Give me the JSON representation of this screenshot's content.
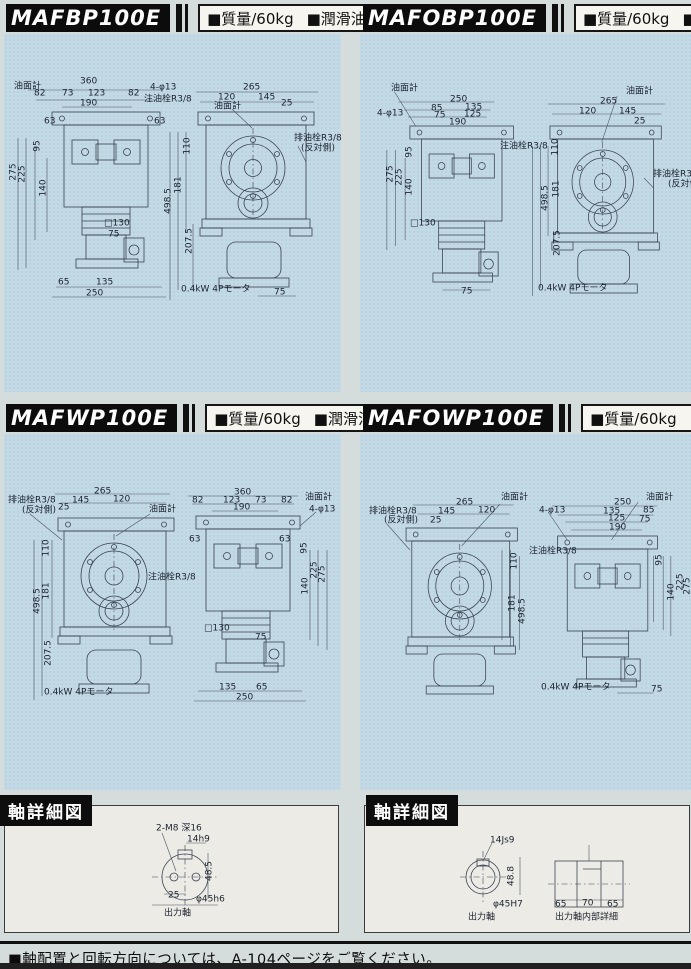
{
  "page": {
    "footer_note": "■軸配置と回転方向については、A-104ページをご覧ください。"
  },
  "panels": [
    {
      "model": "MAFBP100E",
      "mass_label": "■質量/60kg",
      "oil_label": "■潤滑油量/2.5",
      "labels": [
        {
          "t": "油面計",
          "x": 14,
          "y": 87,
          "n": "oil-gauge-label"
        },
        {
          "t": "360",
          "x": 80,
          "y": 82
        },
        {
          "t": "82",
          "x": 34,
          "y": 94
        },
        {
          "t": "73",
          "x": 62,
          "y": 94
        },
        {
          "t": "123",
          "x": 88,
          "y": 94
        },
        {
          "t": "82",
          "x": 128,
          "y": 94
        },
        {
          "t": "190",
          "x": 80,
          "y": 104
        },
        {
          "t": "4-φ13",
          "x": 150,
          "y": 88
        },
        {
          "t": "注油栓R3/8",
          "x": 144,
          "y": 100,
          "n": "filler-plug-label"
        },
        {
          "t": "63",
          "x": 44,
          "y": 122
        },
        {
          "t": "63",
          "x": 154,
          "y": 122
        },
        {
          "t": "95",
          "x": 38,
          "y": 146,
          "v": 1
        },
        {
          "t": "275",
          "x": 14,
          "y": 172,
          "v": 1
        },
        {
          "t": "225",
          "x": 23,
          "y": 174,
          "v": 1
        },
        {
          "t": "140",
          "x": 44,
          "y": 188,
          "v": 1
        },
        {
          "t": "□130",
          "x": 104,
          "y": 224
        },
        {
          "t": "75",
          "x": 108,
          "y": 235
        },
        {
          "t": "65",
          "x": 58,
          "y": 283
        },
        {
          "t": "135",
          "x": 96,
          "y": 283
        },
        {
          "t": "250",
          "x": 86,
          "y": 294
        },
        {
          "t": "265",
          "x": 243,
          "y": 88
        },
        {
          "t": "120",
          "x": 218,
          "y": 98
        },
        {
          "t": "145",
          "x": 258,
          "y": 98
        },
        {
          "t": "25",
          "x": 281,
          "y": 104
        },
        {
          "t": "油面計",
          "x": 214,
          "y": 107,
          "n": "oil-gauge-label"
        },
        {
          "t": "排油栓R3/8",
          "x": 294,
          "y": 139,
          "n": "drain-plug-label"
        },
        {
          "t": "(反対側)",
          "x": 301,
          "y": 149
        },
        {
          "t": "110",
          "x": 188,
          "y": 146,
          "v": 1
        },
        {
          "t": "181",
          "x": 179,
          "y": 185,
          "v": 1
        },
        {
          "t": "498.5",
          "x": 169,
          "y": 201,
          "v": 1
        },
        {
          "t": "207.5",
          "x": 190,
          "y": 241,
          "v": 1
        },
        {
          "t": "0.4kW 4Pモータ",
          "x": 181,
          "y": 290,
          "n": "motor-label"
        },
        {
          "t": "75",
          "x": 274,
          "y": 293
        }
      ]
    },
    {
      "model": "MAFOBP100E",
      "mass_label": "■質量/60kg",
      "oil_label": "■潤滑油量/2.5",
      "labels": [
        {
          "t": "油面計",
          "x": 31,
          "y": 89,
          "n": "oil-gauge-label"
        },
        {
          "t": "250",
          "x": 90,
          "y": 100
        },
        {
          "t": "85",
          "x": 71,
          "y": 109
        },
        {
          "t": "135",
          "x": 105,
          "y": 108
        },
        {
          "t": "75",
          "x": 74,
          "y": 116
        },
        {
          "t": "125",
          "x": 104,
          "y": 115
        },
        {
          "t": "190",
          "x": 89,
          "y": 123
        },
        {
          "t": "4-φ13",
          "x": 17,
          "y": 114
        },
        {
          "t": "95",
          "x": 50,
          "y": 152,
          "v": 1
        },
        {
          "t": "275",
          "x": 31,
          "y": 174,
          "v": 1
        },
        {
          "t": "225",
          "x": 40,
          "y": 177,
          "v": 1
        },
        {
          "t": "140",
          "x": 50,
          "y": 187,
          "v": 1
        },
        {
          "t": "注油栓R3/8",
          "x": 140,
          "y": 147,
          "n": "filler-plug-label"
        },
        {
          "t": "□130",
          "x": 50,
          "y": 224
        },
        {
          "t": "75",
          "x": 101,
          "y": 292
        },
        {
          "t": "油面計",
          "x": 266,
          "y": 92,
          "n": "oil-gauge-label"
        },
        {
          "t": "265",
          "x": 240,
          "y": 102
        },
        {
          "t": "120",
          "x": 219,
          "y": 112
        },
        {
          "t": "145",
          "x": 259,
          "y": 112
        },
        {
          "t": "25",
          "x": 274,
          "y": 122
        },
        {
          "t": "110",
          "x": 196,
          "y": 147,
          "v": 1
        },
        {
          "t": "181",
          "x": 197,
          "y": 189,
          "v": 1
        },
        {
          "t": "498.5",
          "x": 186,
          "y": 198,
          "v": 1
        },
        {
          "t": "排油栓R3/8",
          "x": 293,
          "y": 175,
          "n": "drain-plug-label"
        },
        {
          "t": "(反対側)",
          "x": 308,
          "y": 185
        },
        {
          "t": "207.5",
          "x": 198,
          "y": 243,
          "v": 1
        },
        {
          "t": "0.4kW 4Pモータ",
          "x": 178,
          "y": 289,
          "n": "motor-label"
        }
      ]
    },
    {
      "model": "MAFWP100E",
      "mass_label": "■質量/60kg",
      "oil_label": "■潤滑油量/4.0",
      "labels": [
        {
          "t": "排油栓R3/8",
          "x": 8,
          "y": 101,
          "n": "drain-plug-label"
        },
        {
          "t": "(反対側)",
          "x": 22,
          "y": 111
        },
        {
          "t": "265",
          "x": 94,
          "y": 92
        },
        {
          "t": "145",
          "x": 72,
          "y": 101
        },
        {
          "t": "120",
          "x": 113,
          "y": 100
        },
        {
          "t": "25",
          "x": 58,
          "y": 108
        },
        {
          "t": "油面計",
          "x": 149,
          "y": 110,
          "n": "oil-gauge-label"
        },
        {
          "t": "110",
          "x": 47,
          "y": 148,
          "v": 1
        },
        {
          "t": "181",
          "x": 47,
          "y": 191,
          "v": 1
        },
        {
          "t": "498.5",
          "x": 38,
          "y": 201,
          "v": 1
        },
        {
          "t": "注油栓R3/8",
          "x": 148,
          "y": 178,
          "n": "filler-plug-label"
        },
        {
          "t": "207.5",
          "x": 49,
          "y": 253,
          "v": 1
        },
        {
          "t": "0.4kW 4Pモータ",
          "x": 44,
          "y": 293,
          "n": "motor-label"
        },
        {
          "t": "360",
          "x": 234,
          "y": 93
        },
        {
          "t": "82",
          "x": 192,
          "y": 101
        },
        {
          "t": "123",
          "x": 223,
          "y": 101
        },
        {
          "t": "73",
          "x": 255,
          "y": 101
        },
        {
          "t": "82",
          "x": 281,
          "y": 101
        },
        {
          "t": "190",
          "x": 233,
          "y": 108
        },
        {
          "t": "油面計",
          "x": 305,
          "y": 98,
          "n": "oil-gauge-label"
        },
        {
          "t": "4-φ13",
          "x": 309,
          "y": 110
        },
        {
          "t": "63",
          "x": 189,
          "y": 140
        },
        {
          "t": "63",
          "x": 279,
          "y": 140
        },
        {
          "t": "95",
          "x": 305,
          "y": 148,
          "v": 1
        },
        {
          "t": "225",
          "x": 315,
          "y": 170,
          "v": 1
        },
        {
          "t": "275",
          "x": 323,
          "y": 174,
          "v": 1
        },
        {
          "t": "140",
          "x": 306,
          "y": 186,
          "v": 1
        },
        {
          "t": "□130",
          "x": 204,
          "y": 229
        },
        {
          "t": "75",
          "x": 255,
          "y": 238
        },
        {
          "t": "135",
          "x": 219,
          "y": 288
        },
        {
          "t": "65",
          "x": 256,
          "y": 288
        },
        {
          "t": "250",
          "x": 236,
          "y": 298
        }
      ]
    },
    {
      "model": "MAFOWP100E",
      "mass_label": "■質量/60kg",
      "oil_label": "■潤滑油量/4.0",
      "labels": [
        {
          "t": "排油栓R3/8",
          "x": 9,
          "y": 112,
          "n": "drain-plug-label"
        },
        {
          "t": "(反対側)",
          "x": 24,
          "y": 121
        },
        {
          "t": "265",
          "x": 96,
          "y": 103
        },
        {
          "t": "145",
          "x": 78,
          "y": 112
        },
        {
          "t": "120",
          "x": 118,
          "y": 111
        },
        {
          "t": "25",
          "x": 70,
          "y": 121
        },
        {
          "t": "油面計",
          "x": 141,
          "y": 98,
          "n": "oil-gauge-label"
        },
        {
          "t": "110",
          "x": 155,
          "y": 161,
          "v": 1
        },
        {
          "t": "181",
          "x": 153,
          "y": 203,
          "v": 1
        },
        {
          "t": "498.5",
          "x": 163,
          "y": 211,
          "v": 1
        },
        {
          "t": "注油栓R3/8",
          "x": 169,
          "y": 152,
          "n": "filler-plug-label"
        },
        {
          "t": "0.4kW 4Pモータ",
          "x": 181,
          "y": 288,
          "n": "motor-label"
        },
        {
          "t": "250",
          "x": 254,
          "y": 103
        },
        {
          "t": "135",
          "x": 243,
          "y": 112
        },
        {
          "t": "85",
          "x": 283,
          "y": 111
        },
        {
          "t": "125",
          "x": 248,
          "y": 119
        },
        {
          "t": "75",
          "x": 279,
          "y": 120
        },
        {
          "t": "190",
          "x": 249,
          "y": 128
        },
        {
          "t": "油面計",
          "x": 286,
          "y": 98,
          "n": "oil-gauge-label"
        },
        {
          "t": "4-φ13",
          "x": 179,
          "y": 111
        },
        {
          "t": "95",
          "x": 300,
          "y": 160,
          "v": 1
        },
        {
          "t": "225",
          "x": 321,
          "y": 182,
          "v": 1
        },
        {
          "t": "275",
          "x": 328,
          "y": 186,
          "v": 1
        },
        {
          "t": "140",
          "x": 312,
          "y": 192,
          "v": 1
        },
        {
          "t": "75",
          "x": 291,
          "y": 290
        }
      ]
    }
  ],
  "shaft_sections": [
    {
      "title": "軸詳細図",
      "labels": [
        {
          "t": "2-M8 深16",
          "x": 156,
          "y": 34
        },
        {
          "t": "14h9",
          "x": 187,
          "y": 45
        },
        {
          "t": "48.5",
          "x": 210,
          "y": 76,
          "v": 1
        },
        {
          "t": "25",
          "x": 168,
          "y": 101
        },
        {
          "t": "φ45h6",
          "x": 196,
          "y": 105
        },
        {
          "t": "出力軸",
          "x": 164,
          "y": 119,
          "n": "output-shaft-label"
        }
      ]
    },
    {
      "title": "軸詳細図",
      "labels": [
        {
          "t": "14Js9",
          "x": 130,
          "y": 46
        },
        {
          "t": "48.8",
          "x": 152,
          "y": 81,
          "v": 1
        },
        {
          "t": "φ45H7",
          "x": 133,
          "y": 110
        },
        {
          "t": "出力軸",
          "x": 108,
          "y": 123,
          "n": "output-shaft-label"
        },
        {
          "t": "65",
          "x": 195,
          "y": 110
        },
        {
          "t": "70",
          "x": 222,
          "y": 109
        },
        {
          "t": "65",
          "x": 247,
          "y": 110
        },
        {
          "t": "出力軸内部詳細",
          "x": 195,
          "y": 123,
          "n": "shaft-bore-detail-label"
        }
      ]
    }
  ]
}
